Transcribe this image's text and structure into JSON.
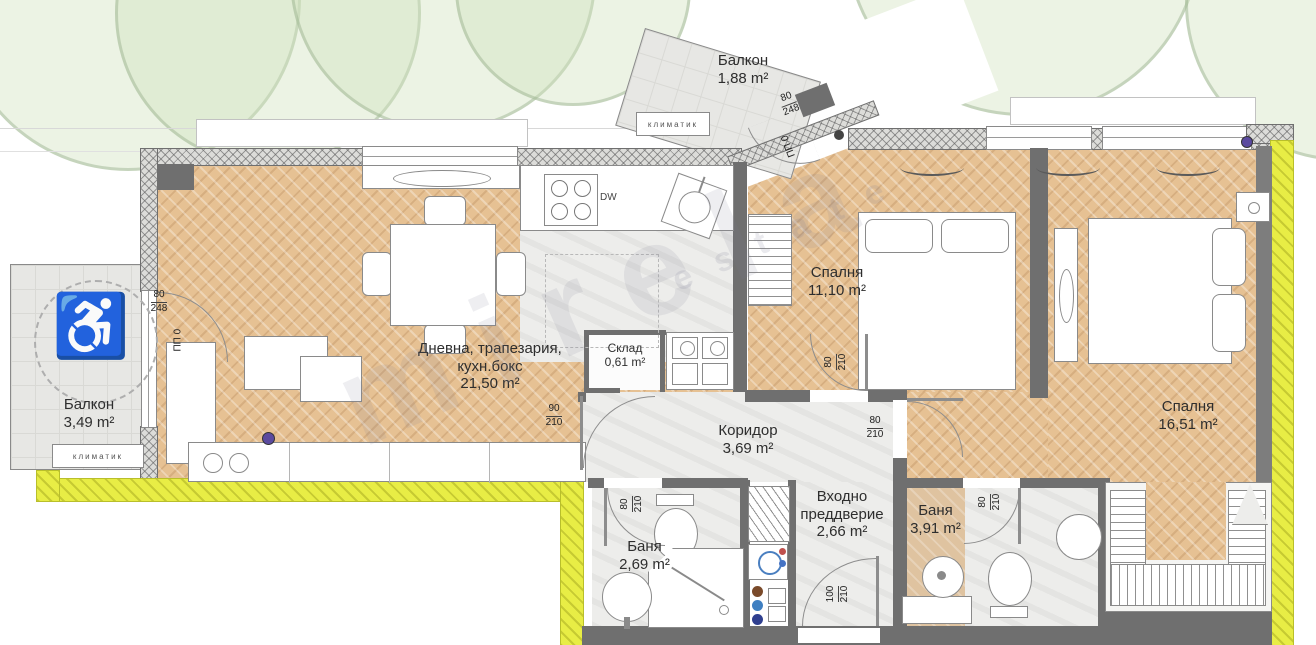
{
  "watermark": {
    "main": "mirela",
    "sub": "estate"
  },
  "rooms": {
    "living": {
      "line1": "Дневна, трапезария,",
      "line2": "кухн.бокс",
      "area": "21,50 m²"
    },
    "bedroom1": {
      "name": "Спалня",
      "area": "11,10 m²"
    },
    "bedroom2": {
      "name": "Спалня",
      "area": "16,51 m²"
    },
    "corridor": {
      "name": "Коридор",
      "area": "3,69 m²"
    },
    "entry": {
      "line1": "Входно",
      "line2": "преддверие",
      "area": "2,66 m²"
    },
    "bath_small": {
      "name": "Баня",
      "area": "2,69 m²"
    },
    "bath_large": {
      "name": "Баня",
      "area": "3,91 m²"
    },
    "storage": {
      "name": "Склад",
      "area": "0,61 m²"
    },
    "balcony_left": {
      "name": "Балкон",
      "area": "3,49 m²"
    },
    "balcony_top": {
      "name": "Балкон",
      "area": "1,88 m²"
    }
  },
  "equipment": {
    "ac_left": "климатик",
    "ac_top": "климатик",
    "dishwasher": "DW",
    "accessible_icon": "♿"
  },
  "dimensions": {
    "balcony_left_door": {
      "w": "80",
      "h": "248",
      "type": "ПП 0"
    },
    "balcony_top_door": {
      "w": "80",
      "h": "248",
      "type": "ПП 0"
    },
    "living_door": {
      "w": "90",
      "h": "210"
    },
    "bedroom1_door": {
      "w": "80",
      "h": "210"
    },
    "bedroom2_door": {
      "w": "80",
      "h": "210"
    },
    "bath_small_door": {
      "w": "80",
      "h": "210"
    },
    "bath_large_door": {
      "w": "80",
      "h": "210"
    },
    "entry_door": {
      "w": "100",
      "h": "210"
    }
  },
  "colors": {
    "wood": "#e6c193",
    "wall": "#6f6f6f",
    "boundary_highlight": "#e8ed45",
    "tile": "#ededeb",
    "tree": "#d0e2bc"
  }
}
